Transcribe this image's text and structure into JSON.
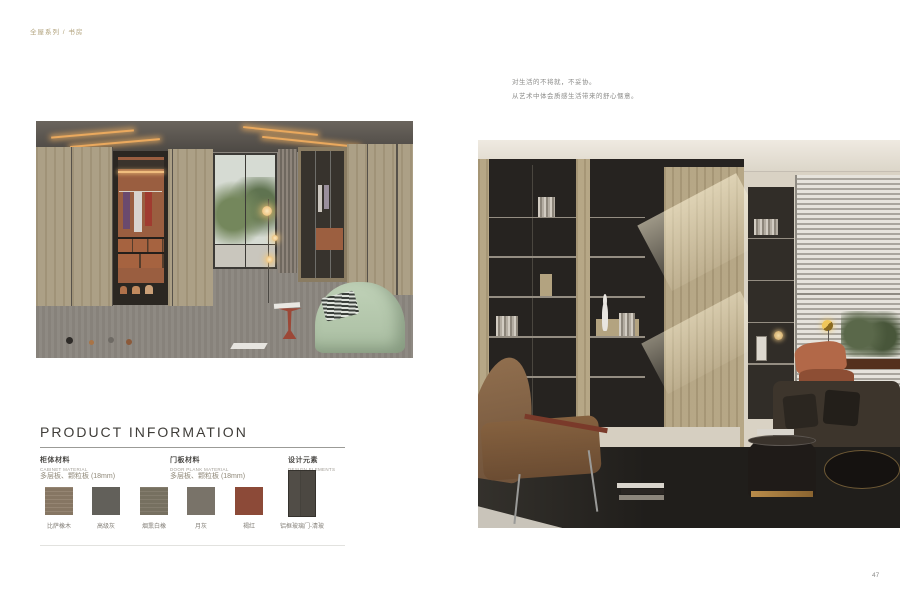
{
  "page": {
    "header": "全屋系列 / 书房",
    "page_number": "47"
  },
  "intro": {
    "line1": "对生活的不将就，不妥协。",
    "line2": "从艺术中体会质感生活带来的舒心惬意。"
  },
  "product_info": {
    "title": "PRODUCT INFORMATION",
    "columns": [
      {
        "zh": "柜体材料",
        "en": "CABINET MATERIAL",
        "spec": "多层板、颗粒板 (18mm)"
      },
      {
        "zh": "门板材料",
        "en": "DOOR PLANK MATERIAL",
        "spec": "多层板、颗粒板 (18mm)"
      },
      {
        "zh": "设计元素",
        "en": "DESIGN ELEMENTS"
      }
    ],
    "swatches": [
      {
        "label": "比萨橡木",
        "color": "#8d7c68"
      },
      {
        "label": "高级灰",
        "color": "#62605a"
      },
      {
        "label": "烟熏白橡",
        "color": "#7b7464"
      },
      {
        "label": "月灰",
        "color": "#797369"
      },
      {
        "label": "褐红",
        "color": "#8c4a38"
      }
    ],
    "design_element": {
      "label": "铝框玻璃门-清玻",
      "color": "#46423c"
    }
  }
}
